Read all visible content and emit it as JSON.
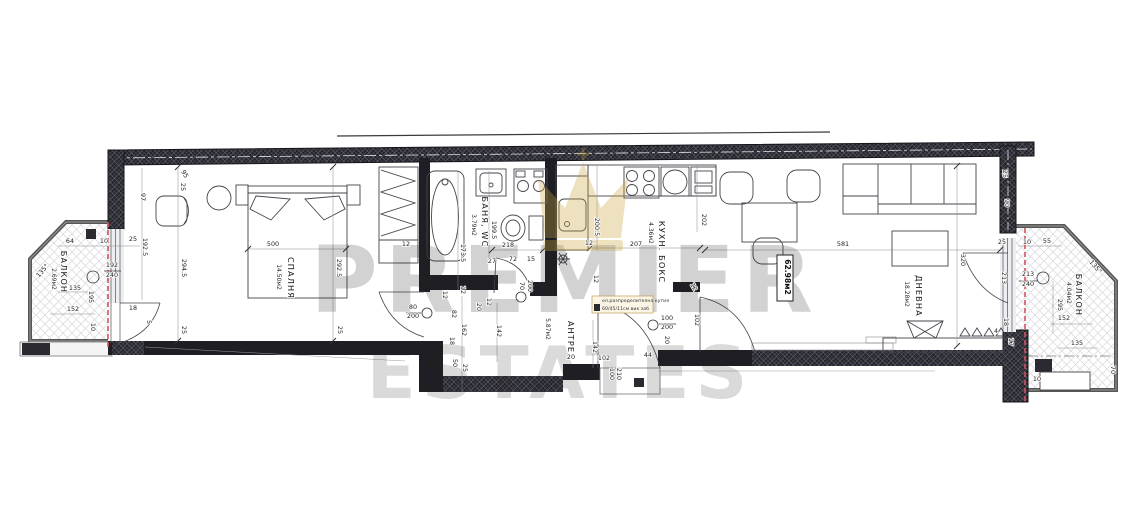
{
  "watermark": {
    "line1": "PREMIER",
    "line2": "ESTATES"
  },
  "total_area": "62.98м2",
  "note": {
    "line1": "ел.разпределителна кутия",
    "line2": "60/45/11см вик заб"
  },
  "colors": {
    "wall": "#1e1e24",
    "hatch_light": "#5a5a66",
    "balcony_hatch": "#d8d8de",
    "red_line": "#d94f5c",
    "gold": "#c9a740",
    "watermark": "#8f8f94"
  },
  "rooms": [
    {
      "id": "balcony-left",
      "name": "БАЛКОН",
      "area": "2.69м2",
      "label": {
        "x": 61,
        "y": 272,
        "r": 90
      },
      "area_label": {
        "x": 52,
        "y": 279,
        "r": 90
      }
    },
    {
      "id": "bedroom",
      "name": "СПАЛНЯ",
      "area": "14.50м2",
      "label": {
        "x": 288,
        "y": 278,
        "r": 90
      },
      "area_label": {
        "x": 277,
        "y": 277,
        "r": 90
      }
    },
    {
      "id": "bathroom",
      "name": "БАНЯ, WC",
      "area": "3.79м2",
      "label": {
        "x": 482,
        "y": 222,
        "r": 90
      },
      "area_label": {
        "x": 472,
        "y": 225,
        "r": 90
      }
    },
    {
      "id": "kitchen",
      "name": "КУХН. БОКС",
      "area": "4.36м2",
      "label": {
        "x": 659,
        "y": 252,
        "r": 90
      },
      "area_label": {
        "x": 649,
        "y": 233,
        "r": 90
      }
    },
    {
      "id": "hall",
      "name": "АНТРЕ",
      "area": "5.87м2",
      "label": {
        "x": 568,
        "y": 337,
        "r": 90
      },
      "area_label": {
        "x": 546,
        "y": 329,
        "r": 90
      }
    },
    {
      "id": "living",
      "name": "ДНЕВНА",
      "area": "18.28м2",
      "label": {
        "x": 916,
        "y": 296,
        "r": 90
      },
      "area_label": {
        "x": 905,
        "y": 294,
        "r": 90
      }
    },
    {
      "id": "balcony-right",
      "name": "БАЛКОН",
      "area": "4.04м2",
      "label": {
        "x": 1076,
        "y": 295,
        "r": 90
      },
      "area_label": {
        "x": 1067,
        "y": 293,
        "r": 90
      }
    }
  ],
  "dimensions": [
    {
      "t": "64",
      "x": 70,
      "y": 243
    },
    {
      "t": "10",
      "x": 104,
      "y": 243
    },
    {
      "t": "25",
      "x": 133,
      "y": 241
    },
    {
      "t": "135°",
      "x": 44,
      "y": 272,
      "r": -50
    },
    {
      "t": "192",
      "x": 112,
      "y": 267
    },
    {
      "t": "240",
      "x": 112,
      "y": 277
    },
    {
      "t": "135",
      "x": 75,
      "y": 290
    },
    {
      "t": "195",
      "x": 89,
      "y": 297,
      "r": 90
    },
    {
      "t": "152",
      "x": 73,
      "y": 311
    },
    {
      "t": "10",
      "x": 91,
      "y": 327,
      "r": 90
    },
    {
      "t": "192.5",
      "x": 143,
      "y": 247,
      "r": 90
    },
    {
      "t": "97",
      "x": 141,
      "y": 197,
      "r": 90
    },
    {
      "t": "18",
      "x": 133,
      "y": 310
    },
    {
      "t": "5",
      "x": 147,
      "y": 322,
      "r": 90
    },
    {
      "t": "95",
      "x": 183,
      "y": 175,
      "r": 60
    },
    {
      "t": "25",
      "x": 181,
      "y": 187,
      "r": 90
    },
    {
      "t": "500",
      "x": 273,
      "y": 246
    },
    {
      "t": "294.5",
      "x": 182,
      "y": 268,
      "r": 90
    },
    {
      "t": "292.5",
      "x": 337,
      "y": 268,
      "r": 90
    },
    {
      "t": "25",
      "x": 182,
      "y": 330,
      "r": 90
    },
    {
      "t": "25",
      "x": 338,
      "y": 330,
      "r": 90
    },
    {
      "t": "12",
      "x": 406,
      "y": 246
    },
    {
      "t": "173.5",
      "x": 461,
      "y": 253,
      "r": 90
    },
    {
      "t": "199.5",
      "x": 492,
      "y": 230,
      "r": 90
    },
    {
      "t": "218",
      "x": 508,
      "y": 247
    },
    {
      "t": "27",
      "x": 492,
      "y": 263
    },
    {
      "t": "72",
      "x": 513,
      "y": 261
    },
    {
      "t": "15",
      "x": 531,
      "y": 261
    },
    {
      "t": "70",
      "x": 520,
      "y": 286,
      "r": 90
    },
    {
      "t": "200",
      "x": 528,
      "y": 286,
      "r": 90
    },
    {
      "t": "12",
      "x": 443,
      "y": 295,
      "r": 90
    },
    {
      "t": "12",
      "x": 461,
      "y": 290,
      "r": 90
    },
    {
      "t": "20",
      "x": 477,
      "y": 307,
      "r": 90
    },
    {
      "t": "12",
      "x": 487,
      "y": 302,
      "r": 90
    },
    {
      "t": "82",
      "x": 452,
      "y": 314,
      "r": 90
    },
    {
      "t": "80",
      "x": 413,
      "y": 309
    },
    {
      "t": "200",
      "x": 413,
      "y": 318
    },
    {
      "t": "162",
      "x": 462,
      "y": 330,
      "r": 90
    },
    {
      "t": "18",
      "x": 450,
      "y": 341,
      "r": 90
    },
    {
      "t": "50",
      "x": 453,
      "y": 363,
      "r": 90
    },
    {
      "t": "25",
      "x": 463,
      "y": 368,
      "r": 90
    },
    {
      "t": "142",
      "x": 497,
      "y": 331,
      "r": 90
    },
    {
      "t": "20",
      "x": 571,
      "y": 359
    },
    {
      "t": "142",
      "x": 593,
      "y": 347,
      "r": 90
    },
    {
      "t": "102",
      "x": 604,
      "y": 360
    },
    {
      "t": "100",
      "x": 610,
      "y": 374,
      "r": 90
    },
    {
      "t": "210",
      "x": 617,
      "y": 374,
      "r": 90
    },
    {
      "t": "44",
      "x": 648,
      "y": 357
    },
    {
      "t": "20",
      "x": 665,
      "y": 340,
      "r": 90
    },
    {
      "t": "100",
      "x": 667,
      "y": 320
    },
    {
      "t": "200",
      "x": 667,
      "y": 329
    },
    {
      "t": "102",
      "x": 695,
      "y": 320,
      "r": 90
    },
    {
      "t": "200.5",
      "x": 595,
      "y": 227,
      "r": 90
    },
    {
      "t": "207",
      "x": 636,
      "y": 246
    },
    {
      "t": "12",
      "x": 589,
      "y": 245
    },
    {
      "t": "202",
      "x": 702,
      "y": 220,
      "r": 90
    },
    {
      "t": "12",
      "x": 594,
      "y": 279,
      "r": 90
    },
    {
      "t": "12",
      "x": 692,
      "y": 288,
      "r": 60
    },
    {
      "t": "581",
      "x": 843,
      "y": 246
    },
    {
      "t": "320",
      "x": 961,
      "y": 260,
      "r": 90
    },
    {
      "t": "25",
      "x": 1003,
      "y": 174,
      "r": 90
    },
    {
      "t": "90",
      "x": 1005,
      "y": 203,
      "r": 90
    },
    {
      "t": "25",
      "x": 1002,
      "y": 244
    },
    {
      "t": "10",
      "x": 1027,
      "y": 244
    },
    {
      "t": "55",
      "x": 1047,
      "y": 243
    },
    {
      "t": "213",
      "x": 1002,
      "y": 278,
      "r": 90
    },
    {
      "t": "213",
      "x": 1028,
      "y": 276
    },
    {
      "t": "240",
      "x": 1028,
      "y": 286
    },
    {
      "t": "18",
      "x": 1004,
      "y": 322,
      "r": 90
    },
    {
      "t": "4",
      "x": 996,
      "y": 333
    },
    {
      "t": "17",
      "x": 1009,
      "y": 342,
      "r": 90
    },
    {
      "t": "295",
      "x": 1058,
      "y": 305,
      "r": 90
    },
    {
      "t": "152",
      "x": 1064,
      "y": 320
    },
    {
      "t": "135",
      "x": 1077,
      "y": 345
    },
    {
      "t": "135°",
      "x": 1094,
      "y": 268,
      "r": 50
    },
    {
      "t": "70",
      "x": 1111,
      "y": 370,
      "r": 90
    },
    {
      "t": "10",
      "x": 1037,
      "y": 381
    }
  ],
  "window_marks": [
    {
      "x": 93,
      "y": 277,
      "r": 6
    },
    {
      "x": 1043,
      "y": 278,
      "r": 6
    },
    {
      "x": 427,
      "y": 313,
      "r": 5
    },
    {
      "x": 521,
      "y": 297,
      "r": 5
    },
    {
      "x": 653,
      "y": 325,
      "r": 5
    }
  ]
}
